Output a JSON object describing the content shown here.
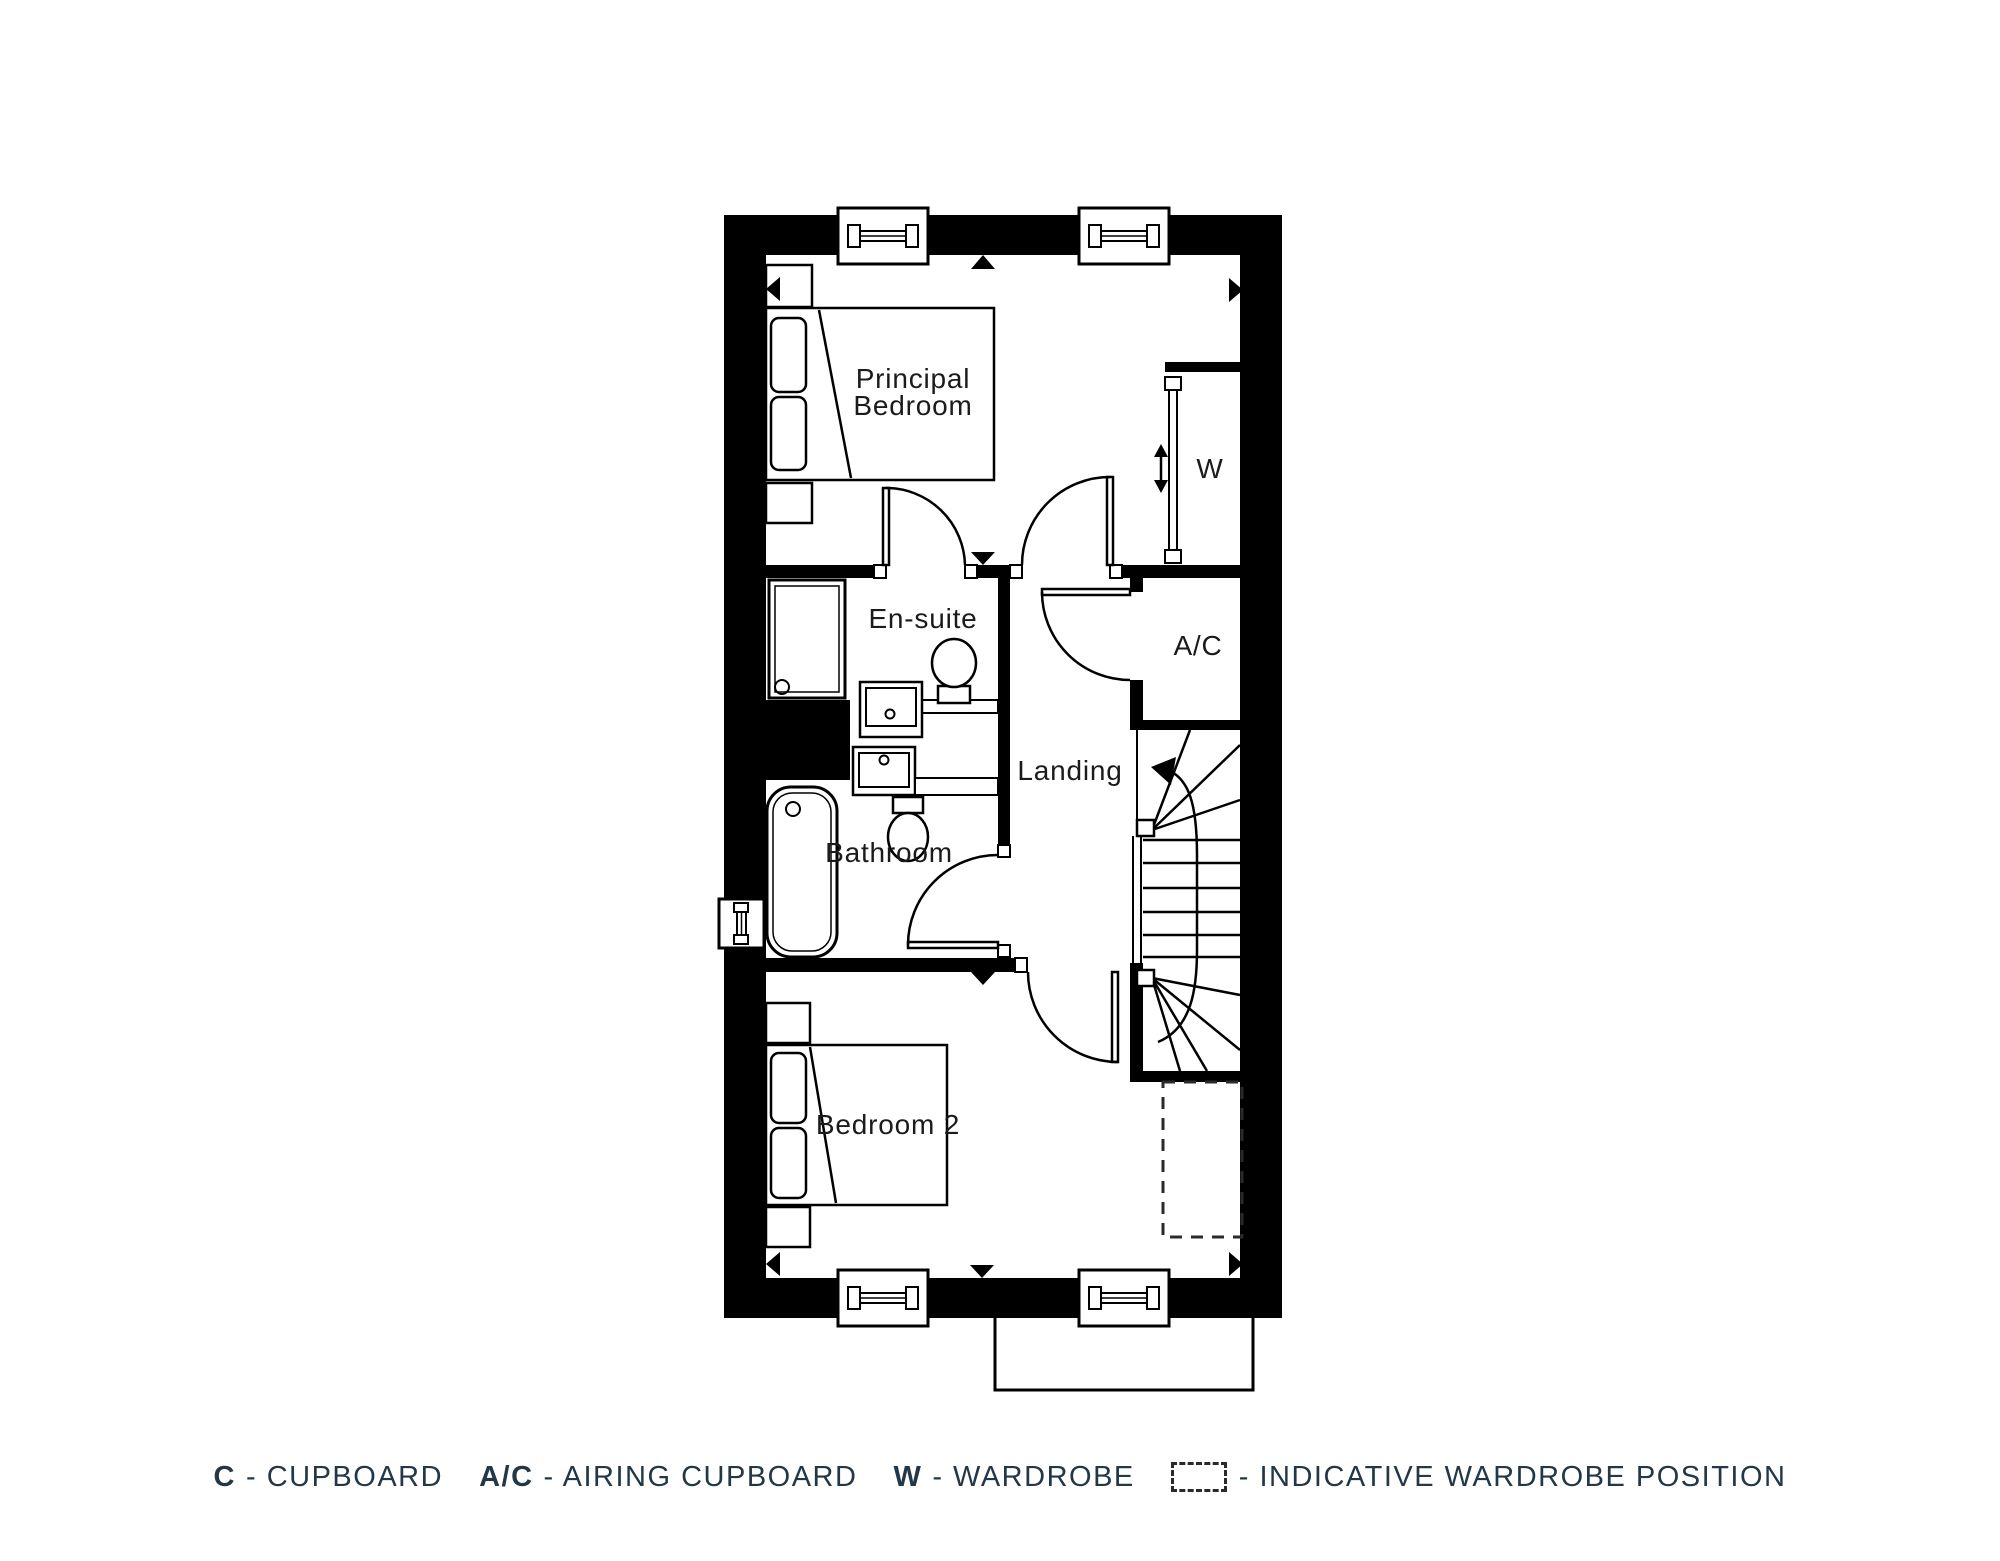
{
  "colors": {
    "wall": "#000000",
    "linework": "#000000",
    "room_label": "#1b1b1b",
    "legend_text": "#223848",
    "background": "#ffffff"
  },
  "floorplan": {
    "rooms": {
      "principal_bedroom": {
        "label_line1": "Principal",
        "label_line2": "Bedroom"
      },
      "ensuite": {
        "label": "En-suite"
      },
      "wardrobe": {
        "label": "W"
      },
      "airing_cupboard": {
        "label": "A/C"
      },
      "landing": {
        "label": "Landing"
      },
      "bathroom": {
        "label": "Bathroom"
      },
      "bedroom2": {
        "label": "Bedroom 2"
      }
    }
  },
  "legend": {
    "items": [
      {
        "key": "C",
        "desc": "- CUPBOARD"
      },
      {
        "key": "A/C",
        "desc": "- AIRING CUPBOARD"
      },
      {
        "key": "W",
        "desc": "- WARDROBE"
      },
      {
        "key": "",
        "icon": "dashed-wardrobe-box",
        "desc": "- INDICATIVE WARDROBE POSITION"
      }
    ]
  }
}
